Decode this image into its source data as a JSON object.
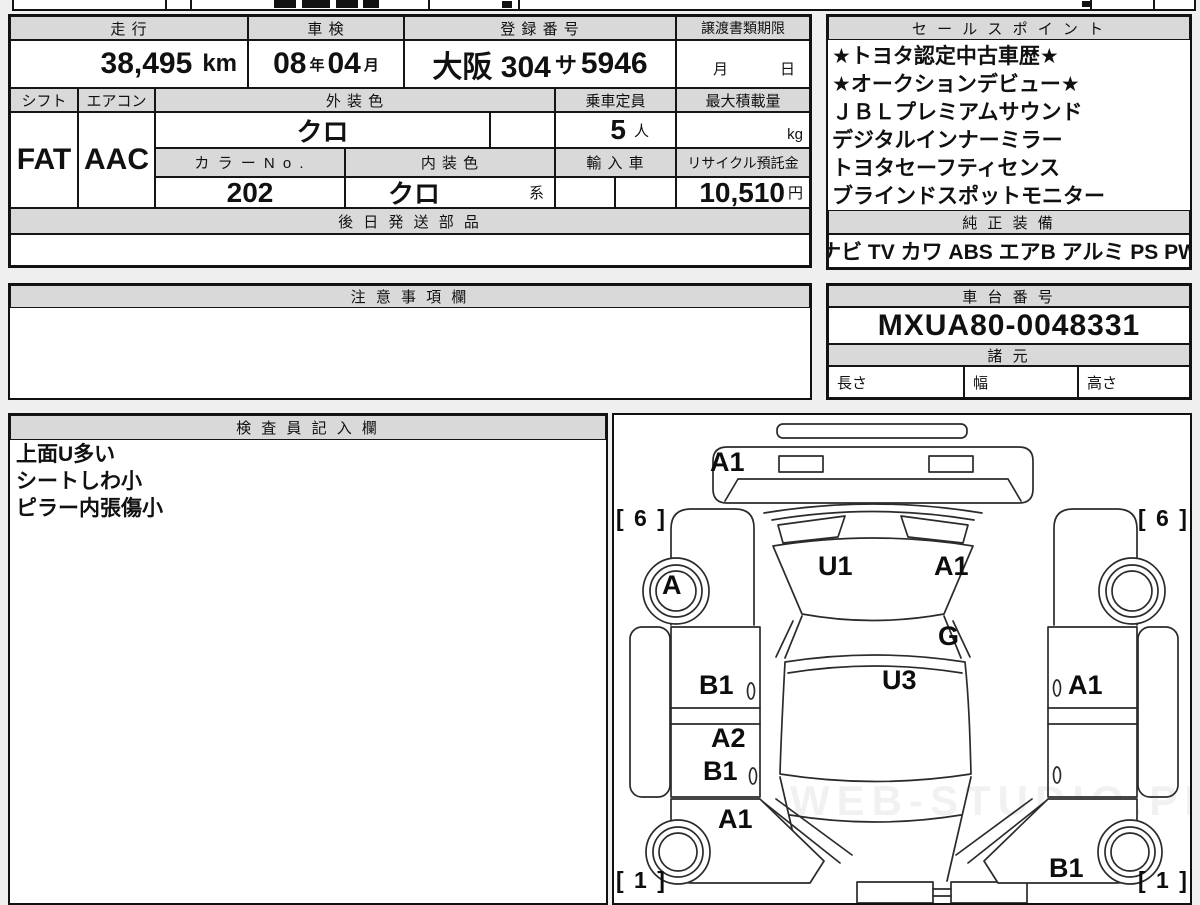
{
  "vehicle": {
    "mileage_label": "走 行",
    "mileage_value": "38,495",
    "mileage_unit": "km",
    "inspection_label": "車 検",
    "inspection_year": "08",
    "inspection_year_unit": "年",
    "inspection_month": "04",
    "inspection_month_unit": "月",
    "registration_label": "登 録 番 号",
    "registration_prefix": "大阪 304",
    "registration_kana": "サ",
    "registration_number": "5946",
    "transfer_label": "譲渡書類期限",
    "transfer_month_label": "月",
    "transfer_day_label": "日",
    "shift_label": "シフト",
    "shift_value": "FAT",
    "aircon_label": "エアコン",
    "aircon_value": "AAC",
    "exterior_color_label": "外 装 色",
    "exterior_color_value": "クロ",
    "capacity_label": "乗車定員",
    "capacity_value": "5",
    "capacity_unit": "人",
    "max_load_label": "最大積載量",
    "max_load_unit": "kg",
    "color_no_label": "カ ラ ー N o .",
    "color_no_value": "202",
    "interior_color_label": "内 装 色",
    "interior_color_value": "クロ",
    "interior_color_suffix": "系",
    "import_label": "輸 入 車",
    "recycle_label": "リサイクル預託金",
    "recycle_value": "10,510",
    "recycle_unit": "円",
    "later_parts_label": "後 日 発 送 部 品"
  },
  "sales": {
    "title": "セ ー ル ス ポ イ ン ト",
    "points": [
      "★トヨタ認定中古車歴★",
      "★オークションデビュー★",
      "ＪＢＬプレミアムサウンド",
      "デジタルインナーミラー",
      "トヨタセーフティセンス",
      "ブラインドスポットモニター"
    ]
  },
  "equipment": {
    "title": "純 正 装 備",
    "items": [
      "ナビ",
      "TV",
      "カワ",
      "ABS",
      "エアB",
      "アルミ",
      "PS",
      "PW"
    ]
  },
  "notes": {
    "title": "注 意 事 項 欄"
  },
  "chassis": {
    "title": "車 台 番 号",
    "value": "MXUA80-0048331",
    "specs_title": "諸 元",
    "length_label": "長さ",
    "width_label": "幅",
    "height_label": "高さ"
  },
  "inspector": {
    "title": "検 査 員 記 入 欄",
    "notes": [
      "上面U多い",
      "シートしわ小",
      "ピラー内張傷小"
    ]
  },
  "diagram": {
    "watermark": "WEB-STUDIO.PRO",
    "labels": [
      "A1",
      "[ 6 ]",
      "[ 6 ]",
      "A",
      "U1",
      "A1",
      "G",
      "U3",
      "B1",
      "A1",
      "A2",
      "B1",
      "A1",
      "B1",
      "[ 1 ]",
      "[ 1 ]"
    ]
  }
}
